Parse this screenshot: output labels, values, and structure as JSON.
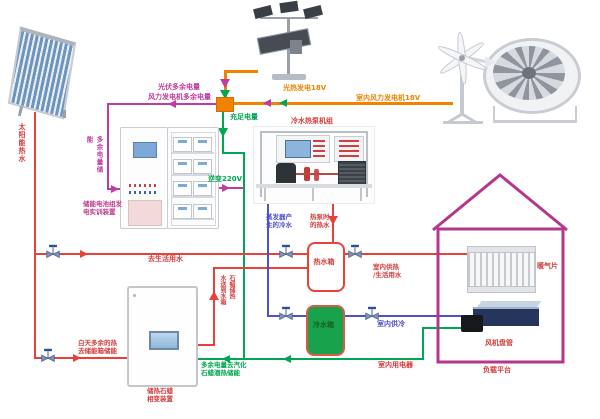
{
  "diagram_title": "solar-wind-heat-pump-energy-system-schematic",
  "colors": {
    "excess_power_line": "#bf3d9e",
    "generation_power_line": "#f08300",
    "sufficient_power_line": "#00a651",
    "hot_water_line": "#e8413c",
    "cold_water_line": "#5050c8",
    "house_outline": "#b5368d",
    "cold_tank_fill": "#18a24b",
    "junction_fill": "#f08300"
  },
  "labels": {
    "pv_excess": "光伏多余电量",
    "wind_excess": "风力发电机多余电量",
    "pv_generation": "光热发电18V",
    "wind_generation": "室内风力发电机18V",
    "sufficient_power": "充足电量",
    "heat_pump_unit": "冷水热泵机组",
    "inverter": "逆变220V",
    "excess_to_storage_v": "多余电量储能",
    "solar_hot_water_v": "太阳能热水",
    "battery_cabinet": "储能电池组发\n电实训装置",
    "to_domestic_water": "去生活用水",
    "day_excess_heat": "白天多余的热\n去储能箱储能",
    "paraffin_device": "储热石蜡\n相变装置",
    "excess_vaporize": "多余电量去汽化\n石蜡潜热储能",
    "paraffin_to_tank_col1": "水送到水箱",
    "paraffin_to_tank_col2": "石蜡储热",
    "hot_tank": "热水箱",
    "cold_tank": "冷水箱",
    "evaporator_cold": "蒸发器产\n生的冷水",
    "heat_pump_hot": "热泵时\n的热水",
    "indoor_heating": "室内供热\n/生活用水",
    "indoor_cooling": "室内供冷",
    "indoor_appliances": "室内用电器",
    "radiator": "暖气片",
    "fan_coil": "风机盘管",
    "load_platform": "负载平台"
  },
  "icons": {
    "valve": "gate-valve-icon",
    "arrows": "flow-direction-arrows"
  }
}
